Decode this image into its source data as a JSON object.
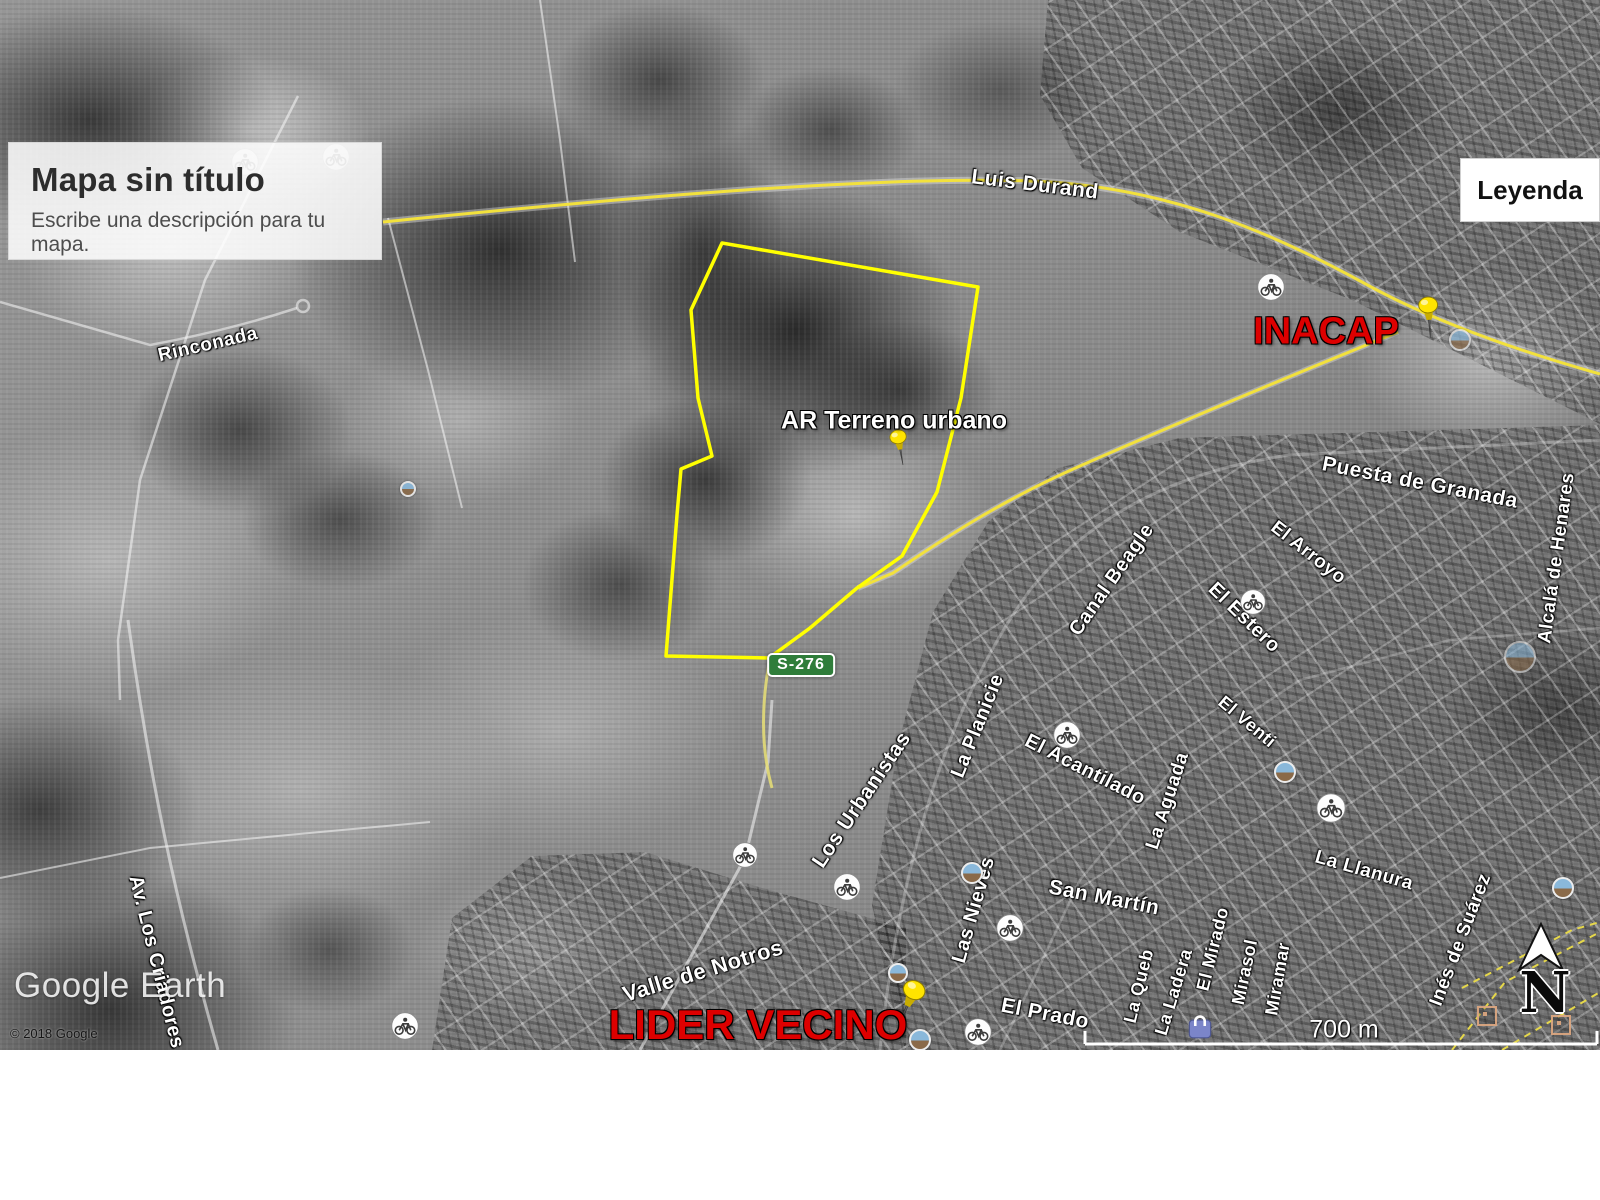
{
  "map": {
    "watermark": "Google Earth",
    "copyright": "© 2018 Google",
    "scale_label": "700 m",
    "compass_label": "N"
  },
  "title_card": {
    "title": "Mapa sin título",
    "subtitle": "Escribe una descripción para tu mapa."
  },
  "legend": {
    "label": "Leyenda"
  },
  "road_shield": {
    "label": "S-276",
    "bg_color": "#2f7d3a"
  },
  "colors": {
    "parcel_outline": "#ffff00",
    "road_yellow": "#f2e13c",
    "placemark_red": "#dd0000",
    "street_label": "#ffffff"
  },
  "placemarks": [
    {
      "label": "AR Terreno urbano",
      "color": "#ffffff",
      "x": 894,
      "y": 421,
      "fs": 25,
      "pin": {
        "x": 900,
        "y": 452,
        "rot": -10,
        "scale": 0.78
      }
    },
    {
      "label": "INACAP",
      "color": "#dd0000",
      "x": 1326,
      "y": 332,
      "fs": 38,
      "pin": {
        "x": 1429,
        "y": 322,
        "rot": -4,
        "scale": 0.9
      }
    },
    {
      "label": "LIDER VECINO",
      "color": "#dd0000",
      "x": 758,
      "y": 1025,
      "fs": 42,
      "pin": {
        "x": 908,
        "y": 1008,
        "rot": 24,
        "scale": 1.05
      }
    }
  ],
  "street_labels": [
    {
      "text": "Luis Durand",
      "x": 1035,
      "y": 185,
      "rot": 7,
      "fs": 21
    },
    {
      "text": "Rinconada",
      "x": 208,
      "y": 345,
      "rot": -13,
      "fs": 19
    },
    {
      "text": "Av. Los Criadores",
      "x": 156,
      "y": 962,
      "rot": 76,
      "fs": 20
    },
    {
      "text": "Valle de Notros",
      "x": 703,
      "y": 971,
      "rot": -17,
      "fs": 22
    },
    {
      "text": "Los Urbanistas",
      "x": 862,
      "y": 800,
      "rot": -56,
      "fs": 21
    },
    {
      "text": "La Planicie",
      "x": 978,
      "y": 726,
      "rot": -68,
      "fs": 20
    },
    {
      "text": "El Acantilado",
      "x": 1085,
      "y": 770,
      "rot": 27,
      "fs": 20
    },
    {
      "text": "La Aguada",
      "x": 1168,
      "y": 801,
      "rot": -72,
      "fs": 19
    },
    {
      "text": "Canal Beagle",
      "x": 1112,
      "y": 580,
      "rot": -55,
      "fs": 20
    },
    {
      "text": "El Estero",
      "x": 1244,
      "y": 618,
      "rot": 44,
      "fs": 20
    },
    {
      "text": "El Venti",
      "x": 1247,
      "y": 722,
      "rot": 40,
      "fs": 18
    },
    {
      "text": "Puesta de Granada",
      "x": 1420,
      "y": 483,
      "rot": 11,
      "fs": 21
    },
    {
      "text": "El Arroyo",
      "x": 1308,
      "y": 553,
      "rot": 38,
      "fs": 19
    },
    {
      "text": "Alcalá de Henares",
      "x": 1557,
      "y": 558,
      "rot": -82,
      "fs": 19
    },
    {
      "text": "San Martín",
      "x": 1104,
      "y": 898,
      "rot": 11,
      "fs": 21
    },
    {
      "text": "El Prado",
      "x": 1045,
      "y": 1014,
      "rot": 11,
      "fs": 21
    },
    {
      "text": "Las Nieves",
      "x": 974,
      "y": 910,
      "rot": -74,
      "fs": 20
    },
    {
      "text": "La Queb",
      "x": 1139,
      "y": 986,
      "rot": -76,
      "fs": 18
    },
    {
      "text": "La Ladera",
      "x": 1174,
      "y": 992,
      "rot": -73,
      "fs": 18
    },
    {
      "text": "El Mirado",
      "x": 1213,
      "y": 949,
      "rot": -76,
      "fs": 18
    },
    {
      "text": "Mirasol",
      "x": 1245,
      "y": 972,
      "rot": -78,
      "fs": 18
    },
    {
      "text": "Miramar",
      "x": 1278,
      "y": 979,
      "rot": -80,
      "fs": 18
    },
    {
      "text": "La Llanura",
      "x": 1364,
      "y": 871,
      "rot": 16,
      "fs": 19
    },
    {
      "text": "Inés de Suárez",
      "x": 1461,
      "y": 940,
      "rot": -69,
      "fs": 19
    }
  ],
  "bike_icons": [
    {
      "x": 245,
      "y": 162,
      "r": 14,
      "o": 0.5
    },
    {
      "x": 336,
      "y": 157,
      "r": 14,
      "o": 0.5
    },
    {
      "x": 1271,
      "y": 287,
      "r": 14,
      "o": 1
    },
    {
      "x": 405,
      "y": 1026,
      "r": 14,
      "o": 1
    },
    {
      "x": 745,
      "y": 855,
      "r": 13,
      "o": 1
    },
    {
      "x": 847,
      "y": 887,
      "r": 14,
      "o": 1
    },
    {
      "x": 1010,
      "y": 928,
      "r": 14,
      "o": 1
    },
    {
      "x": 978,
      "y": 1032,
      "r": 14,
      "o": 1
    },
    {
      "x": 1067,
      "y": 735,
      "r": 14,
      "o": 1
    },
    {
      "x": 1253,
      "y": 602,
      "r": 13,
      "o": 1
    },
    {
      "x": 1331,
      "y": 808,
      "r": 15,
      "o": 1
    }
  ],
  "photo_icons": [
    {
      "x": 898,
      "y": 973,
      "r": 10,
      "o": 1
    },
    {
      "x": 920,
      "y": 1040,
      "r": 11,
      "o": 1
    },
    {
      "x": 972,
      "y": 873,
      "r": 11,
      "o": 1
    },
    {
      "x": 1285,
      "y": 772,
      "r": 11,
      "o": 1
    },
    {
      "x": 1520,
      "y": 657,
      "r": 16,
      "o": 0.55
    },
    {
      "x": 1563,
      "y": 888,
      "r": 11,
      "o": 1
    },
    {
      "x": 1460,
      "y": 340,
      "r": 11,
      "o": 0.7
    },
    {
      "x": 408,
      "y": 489,
      "r": 8,
      "o": 0.9
    }
  ],
  "shopping_icons": [
    {
      "x": 1200,
      "y": 1026
    }
  ],
  "square_icons": [
    {
      "x": 1487,
      "y": 1016
    },
    {
      "x": 1561,
      "y": 1025
    }
  ]
}
